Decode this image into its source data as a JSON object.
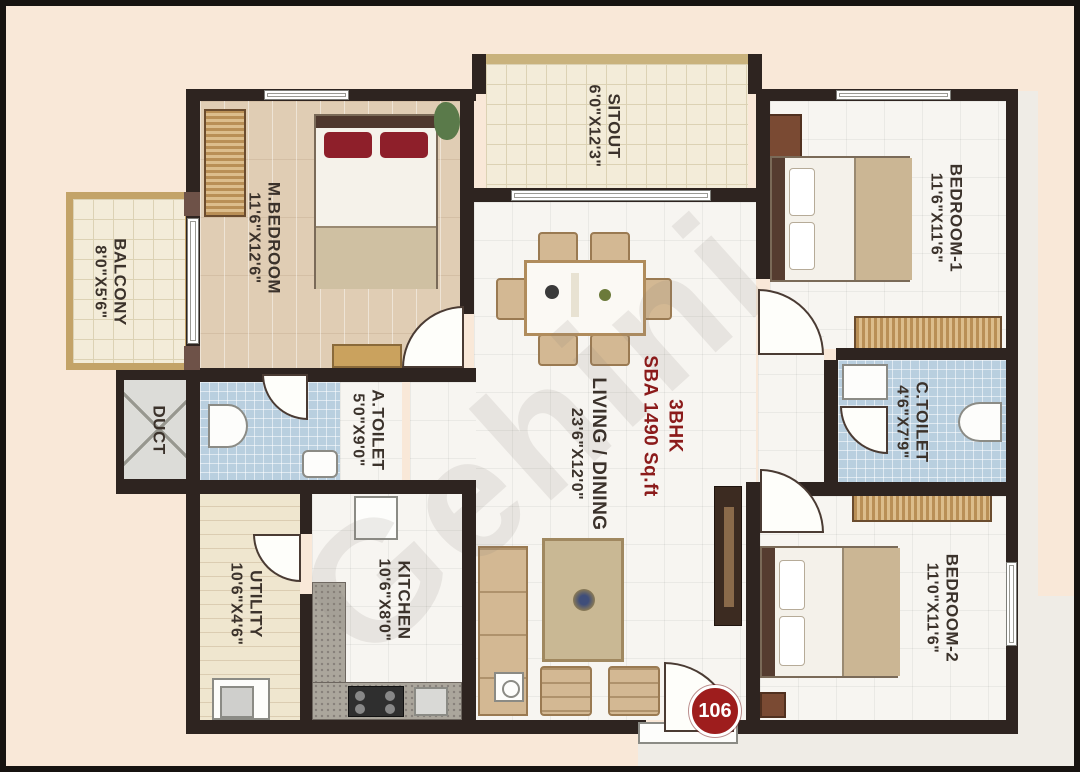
{
  "plan": {
    "type": "floorplan",
    "title": {
      "line1": "3BHK",
      "line2": "SBA 1490 Sq.ft"
    },
    "unit": {
      "number": "106"
    },
    "watermark": {
      "text": "Gehini"
    },
    "colors": {
      "background": "#f9e8d8",
      "wall": "#2e2420",
      "title_red": "#8b1b1b",
      "badge_red": "#9e1d1d",
      "toilet_tile_blue": "#b9cfdf",
      "bedroom_floor_tan": "#e0cdb4"
    },
    "rooms": [
      {
        "name": "BALCONY",
        "dims": "8'0\"X5'6\""
      },
      {
        "name": "M.BEDROOM",
        "dims": "11'6\"X12'6\""
      },
      {
        "name": "SITOUT",
        "dims": "6'0\"X12'3\""
      },
      {
        "name": "BEDROOM-1",
        "dims": "11'6\"X11'6\""
      },
      {
        "name": "DUCT",
        "dims": ""
      },
      {
        "name": "A.TOILET",
        "dims": "5'0\"X9'0\""
      },
      {
        "name": "C.TOILET",
        "dims": "4'6\"X7'9\""
      },
      {
        "name": "UTILITY",
        "dims": "10'6\"X4'6\""
      },
      {
        "name": "KITCHEN",
        "dims": "10'6\"X8'0\""
      },
      {
        "name": "LIVING / DINING",
        "dims": "23'6\"X12'0\""
      },
      {
        "name": "BEDROOM-2",
        "dims": "11'0\"X11'6\""
      }
    ]
  }
}
